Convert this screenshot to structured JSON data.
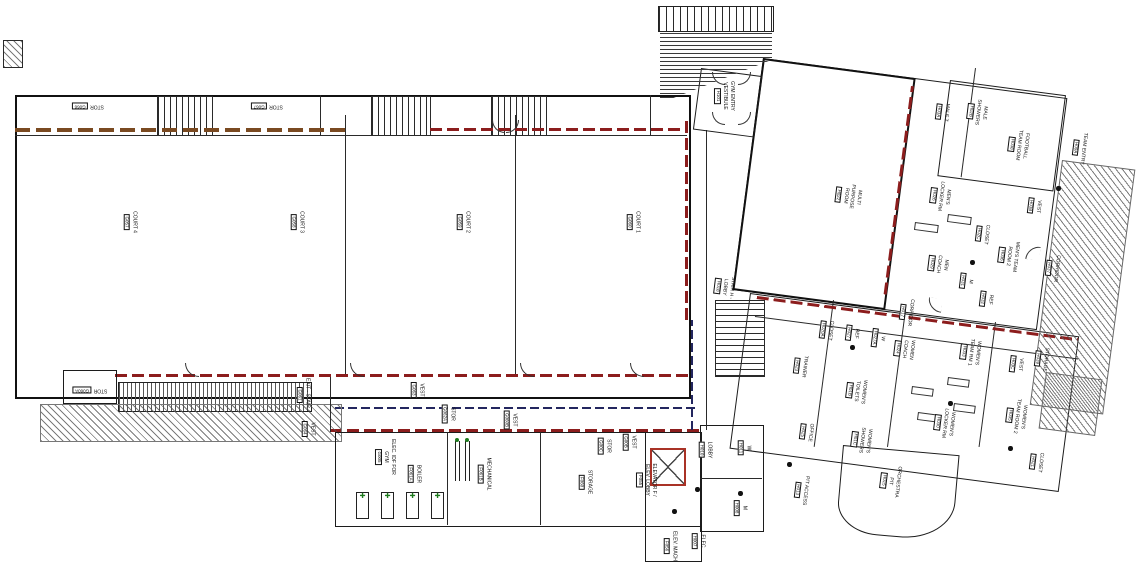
{
  "drawing": {
    "kind": "gymnasium-ground-floor-plan"
  },
  "colors": {
    "walls": "#1c1c1c",
    "fire_rating_red": "#8c1d1d",
    "wood_brown": "#7a4a21",
    "smoke_line_blue": "#23265f",
    "equipment_green": "#1d7a1d",
    "elevator_red": "#a93226"
  },
  "rooms": [
    {
      "id": "court4",
      "lines": [
        "COURT 4"
      ],
      "number": "G057",
      "x": 130,
      "y": 222,
      "rot": 90
    },
    {
      "id": "court3",
      "lines": [
        "COURT 3"
      ],
      "number": "G058",
      "x": 297,
      "y": 222,
      "rot": 90
    },
    {
      "id": "court2",
      "lines": [
        "COURT 2"
      ],
      "number": "G059",
      "x": 463,
      "y": 222,
      "rot": 90
    },
    {
      "id": "court1",
      "lines": [
        "COURT 1"
      ],
      "number": "G060",
      "x": 633,
      "y": 222,
      "rot": 90
    },
    {
      "id": "stor-nw-1",
      "lines": [
        "STOR"
      ],
      "number": "G066",
      "x": 88,
      "y": 106,
      "rot": 180
    },
    {
      "id": "stor-nw-2",
      "lines": [
        "STOR"
      ],
      "number": "G067",
      "x": 267,
      "y": 106,
      "rot": 180
    },
    {
      "id": "stor-sw",
      "lines": [
        "STOR"
      ],
      "number": "G060A",
      "x": 90,
      "y": 390,
      "rot": 180
    },
    {
      "id": "exit-stair-4",
      "lines": [
        "EXIT - STAIR 4"
      ],
      "number": "G061",
      "x": 303,
      "y": 395,
      "rot": 90
    },
    {
      "id": "vest-g064",
      "lines": [
        "VEST"
      ],
      "number": "G064",
      "x": 308,
      "y": 429,
      "rot": 90
    },
    {
      "id": "vest-g063",
      "lines": [
        "VEST"
      ],
      "number": "G063",
      "x": 417,
      "y": 390,
      "rot": 90
    },
    {
      "id": "stor-g062a",
      "lines": [
        "STOR"
      ],
      "number": "G062A",
      "x": 448,
      "y": 414,
      "rot": 90
    },
    {
      "id": "vest-g060b",
      "lines": [
        "VEST"
      ],
      "number": "G060B",
      "x": 510,
      "y": 420,
      "rot": 90
    },
    {
      "id": "stor-g00c",
      "lines": [
        "STOR"
      ],
      "number": "G00C",
      "x": 604,
      "y": 446,
      "rot": 90
    },
    {
      "id": "vest-g00b",
      "lines": [
        "VEST"
      ],
      "number": "G00B",
      "x": 629,
      "y": 442,
      "rot": 90
    },
    {
      "id": "elec-idf-gym",
      "lines": [
        "ELEC. IDF FOR",
        "GYM"
      ],
      "number": "G005",
      "x": 385,
      "y": 457,
      "rot": 90
    },
    {
      "id": "boiler",
      "lines": [
        "BOILER"
      ],
      "number": "F061A",
      "x": 414,
      "y": 474,
      "rot": 90
    },
    {
      "id": "mechanical",
      "lines": [
        "MECHANICAL"
      ],
      "number": "F061B",
      "x": 484,
      "y": 474,
      "rot": 90
    },
    {
      "id": "storage-f060",
      "lines": [
        "STORAGE"
      ],
      "number": "F060",
      "x": 585,
      "y": 482,
      "rot": 90
    },
    {
      "id": "elevator-f",
      "lines": [
        "ELEVATOR F /",
        "ELEV. LOBBY"
      ],
      "number": "F055",
      "x": 646,
      "y": 480,
      "rot": 90
    },
    {
      "id": "elev-mach",
      "lines": [
        "ELEV. MACH"
      ],
      "number": "F056",
      "x": 670,
      "y": 546,
      "rot": 90
    },
    {
      "id": "elec-h007",
      "lines": [
        "ELEC"
      ],
      "number": "H007",
      "x": 698,
      "y": 541,
      "rot": 90
    },
    {
      "id": "lobby",
      "lines": [
        "LOBBY"
      ],
      "number": "H010",
      "x": 705,
      "y": 450,
      "rot": 90
    },
    {
      "id": "toilet-w1",
      "lines": [
        "W"
      ],
      "number": "H011",
      "x": 744,
      "y": 448,
      "rot": 90
    },
    {
      "id": "toilet-m1",
      "lines": [
        "M"
      ],
      "number": "H008",
      "x": 740,
      "y": 508,
      "rot": 90
    },
    {
      "id": "gym-entry-vestibule",
      "lines": [
        "GYM ENTRY",
        "VESTIBULE"
      ],
      "number": "H101",
      "x": 724,
      "y": 96,
      "rot": 90
    },
    {
      "id": "stair-h-lobby",
      "lines": [
        "STAIR H -",
        "LOBBY"
      ],
      "number": "H018",
      "x": 724,
      "y": 287,
      "rot": 97
    },
    {
      "id": "office",
      "lines": [
        "OFFICE"
      ],
      "number": "H025",
      "x": 806,
      "y": 432,
      "rot": 97
    },
    {
      "id": "pit-access",
      "lines": [
        "PIT ACCESS"
      ],
      "number": "H013",
      "x": 801,
      "y": 490,
      "rot": 97
    },
    {
      "id": "multi-purpose-room",
      "lines": [
        "MULTI",
        "PURPOSE",
        "ROOM"
      ],
      "number": "H022",
      "x": 848,
      "y": 196,
      "rot": 97
    },
    {
      "id": "football-team-room",
      "lines": [
        "FOOTBALL",
        "TEAM ROOM"
      ],
      "number": "H038",
      "x": 1018,
      "y": 145,
      "rot": 97
    },
    {
      "id": "male-t",
      "lines": [
        "MALE T"
      ],
      "number": "H03A",
      "x": 942,
      "y": 112,
      "rot": 97
    },
    {
      "id": "male-showers",
      "lines": [
        "MALE",
        "SHOWERS"
      ],
      "number": "H02B",
      "x": 977,
      "y": 112,
      "rot": 97
    },
    {
      "id": "mens-locker-rm",
      "lines": [
        "MEN'S",
        "LOCKER RM"
      ],
      "number": "H026",
      "x": 940,
      "y": 196,
      "rot": 97
    },
    {
      "id": "vest-h03b",
      "lines": [
        "VEST"
      ],
      "number": "H03B",
      "x": 1034,
      "y": 206,
      "rot": 97
    },
    {
      "id": "closet-h02c",
      "lines": [
        "CLOSET"
      ],
      "number": "H02C",
      "x": 982,
      "y": 234,
      "rot": 97
    },
    {
      "id": "men-coach",
      "lines": [
        "MEN",
        "COACH"
      ],
      "number": "H029",
      "x": 938,
      "y": 264,
      "rot": 97
    },
    {
      "id": "mens-team-room-2",
      "lines": [
        "MEN'S TEAM",
        "ROOM 2"
      ],
      "number": "H036",
      "x": 1008,
      "y": 256,
      "rot": 97
    },
    {
      "id": "toilet-m2",
      "lines": [
        "M"
      ],
      "number": "H031",
      "x": 966,
      "y": 281,
      "rot": 97
    },
    {
      "id": "ref-h032",
      "lines": [
        "REF"
      ],
      "number": "H032",
      "x": 986,
      "y": 299,
      "rot": 97
    },
    {
      "id": "corridor-east",
      "lines": [
        "CORRIDOR"
      ],
      "number": "H037",
      "x": 1052,
      "y": 268,
      "rot": 97
    },
    {
      "id": "team-entry",
      "lines": [
        "TEAM ENTRY"
      ],
      "number": "H09A",
      "x": 1079,
      "y": 148,
      "rot": 97
    },
    {
      "id": "corridor-mid",
      "lines": [
        "CORRIDOR"
      ],
      "number": "H017",
      "x": 906,
      "y": 312,
      "rot": 97
    },
    {
      "id": "closet-h020a",
      "lines": [
        "CLOSET"
      ],
      "number": "H020A",
      "x": 826,
      "y": 330,
      "rot": 97
    },
    {
      "id": "ref-h027",
      "lines": [
        "REF"
      ],
      "number": "H027",
      "x": 852,
      "y": 333,
      "rot": 97
    },
    {
      "id": "toilet-w2",
      "lines": [
        "W"
      ],
      "number": "H027A",
      "x": 878,
      "y": 338,
      "rot": 97
    },
    {
      "id": "women-coach",
      "lines": [
        "WOMEN",
        "COACH"
      ],
      "number": "H024",
      "x": 904,
      "y": 349,
      "rot": 97
    },
    {
      "id": "trainer",
      "lines": [
        "TRAINER"
      ],
      "number": "H023",
      "x": 800,
      "y": 366,
      "rot": 97
    },
    {
      "id": "womens-toilets",
      "lines": [
        "WOMEN'S",
        "TOILETS"
      ],
      "number": "H01B",
      "x": 856,
      "y": 391,
      "rot": 97
    },
    {
      "id": "womens-showers",
      "lines": [
        "WOMEN'S",
        "SHOWERS"
      ],
      "number": "H01C",
      "x": 861,
      "y": 440,
      "rot": 97
    },
    {
      "id": "womens-locker-rm",
      "lines": [
        "WOMEN'S",
        "LOCKER RM"
      ],
      "number": "H030",
      "x": 944,
      "y": 423,
      "rot": 97
    },
    {
      "id": "womens-team-rm-1",
      "lines": [
        "WOMEN'S",
        "TEAM RM 1"
      ],
      "number": "H033",
      "x": 970,
      "y": 352,
      "rot": 97
    },
    {
      "id": "vest-h03c",
      "lines": [
        "VEST"
      ],
      "number": "H03C",
      "x": 1016,
      "y": 364,
      "rot": 97
    },
    {
      "id": "storage-h039",
      "lines": [
        "STORAGE"
      ],
      "number": "H039",
      "x": 1041,
      "y": 359,
      "rot": 97
    },
    {
      "id": "womens-team-room-2",
      "lines": [
        "WOMEN'S",
        "TEAM ROOM 2"
      ],
      "number": "H035",
      "x": 1016,
      "y": 416,
      "rot": 97
    },
    {
      "id": "closet-h021",
      "lines": [
        "CLOSET"
      ],
      "number": "H021",
      "x": 1036,
      "y": 462,
      "rot": 97
    },
    {
      "id": "orchestra-pit",
      "lines": [
        "ORCHESTRA",
        "PIT"
      ],
      "number": "H015",
      "x": 890,
      "y": 481,
      "rot": 97
    }
  ]
}
